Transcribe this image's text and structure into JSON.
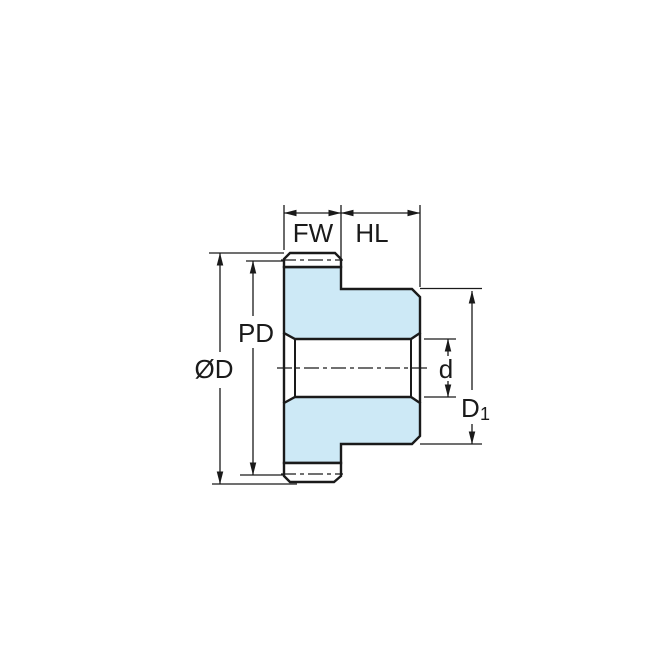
{
  "diagram": {
    "type": "technical-drawing",
    "subject": "spur gear side cross-section with dimension callouts",
    "labels": {
      "face_width": "FW",
      "hub_length": "HL",
      "pitch_diameter": "PD",
      "outside_diameter": "ØD",
      "bore_diameter": "d",
      "hub_diameter_main": "D",
      "hub_diameter_sub": "1"
    },
    "colors": {
      "part_fill": "#cde9f6",
      "line": "#1a1a1a",
      "background": "#ffffff"
    }
  }
}
